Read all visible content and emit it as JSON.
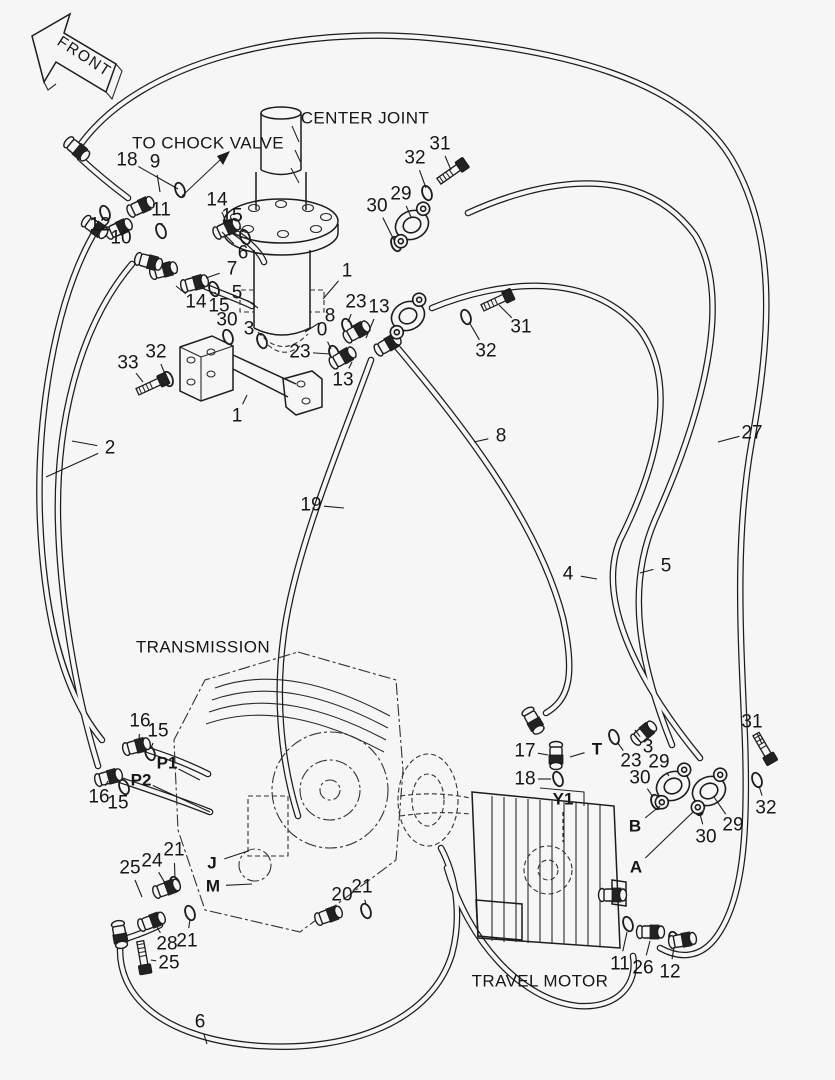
{
  "page": {
    "background": "#f6f6f6",
    "line_color": "#1c1c1c",
    "width": 835,
    "height": 1080
  },
  "front_arrow": {
    "label": "FRONT"
  },
  "labels": [
    {
      "id": "front",
      "text": "FRONT",
      "x": 84,
      "y": 57,
      "size": 15.5,
      "rot": 33,
      "spacing": 1.5
    },
    {
      "id": "to-chock-valve",
      "text": "TO CHOCK VALVE",
      "x": 208,
      "y": 143,
      "size": 17
    },
    {
      "id": "center-joint",
      "text": "CENTER JOINT",
      "x": 365,
      "y": 118,
      "size": 17
    },
    {
      "id": "transmission",
      "text": "TRANSMISSION",
      "x": 203,
      "y": 647,
      "size": 17
    },
    {
      "id": "travel-motor",
      "text": "TRAVEL MOTOR",
      "x": 540,
      "y": 981,
      "size": 17
    }
  ],
  "callouts": [
    {
      "n": "18",
      "x": 127,
      "y": 160,
      "lx": 178,
      "ly": 189
    },
    {
      "n": "9",
      "x": 155,
      "y": 162,
      "lx": 160,
      "ly": 192
    },
    {
      "n": "11",
      "x": 161,
      "y": 210,
      "lx": 162,
      "ly": 226
    },
    {
      "n": "12",
      "x": 100,
      "y": 225,
      "lx": 105,
      "ly": 216
    },
    {
      "n": "10",
      "x": 121,
      "y": 238,
      "lx": 121,
      "ly": 231
    },
    {
      "n": "14",
      "x": 217,
      "y": 200,
      "lx": 226,
      "ly": 222
    },
    {
      "n": "15",
      "x": 232,
      "y": 216,
      "lx": 243,
      "ly": 232
    },
    {
      "n": "6",
      "x": 243,
      "y": 253,
      "lx": 222,
      "ly": 232
    },
    {
      "n": "7",
      "x": 232,
      "y": 269,
      "lx": 206,
      "ly": 278
    },
    {
      "n": "5",
      "x": 237,
      "y": 293,
      "lx": 258,
      "ly": 308
    },
    {
      "n": "14",
      "x": 196,
      "y": 302,
      "lx": 176,
      "ly": 286
    },
    {
      "n": "15",
      "x": 219,
      "y": 306,
      "lx": 215,
      "ly": 292
    },
    {
      "n": "30",
      "x": 227,
      "y": 320,
      "lx": 228,
      "ly": 333
    },
    {
      "n": "3",
      "x": 249,
      "y": 329,
      "lx": 259,
      "ly": 338
    },
    {
      "n": "1",
      "x": 347,
      "y": 271,
      "lx": 323,
      "ly": 299
    },
    {
      "n": "8",
      "x": 330,
      "y": 316,
      "lx": 305,
      "ly": 332
    },
    {
      "n": "23",
      "x": 356,
      "y": 302,
      "lx": 348,
      "ly": 322
    },
    {
      "n": "13",
      "x": 379,
      "y": 307,
      "lx": 366,
      "ly": 338
    },
    {
      "n": "0",
      "x": 322,
      "y": 330,
      "lx": 331,
      "ly": 349
    },
    {
      "n": "23",
      "x": 300,
      "y": 352,
      "lx": 330,
      "ly": 354
    },
    {
      "n": "13",
      "x": 343,
      "y": 380,
      "lx": 352,
      "ly": 362
    },
    {
      "n": "33",
      "x": 128,
      "y": 363,
      "lx": 143,
      "ly": 382
    },
    {
      "n": "32",
      "x": 156,
      "y": 352,
      "lx": 165,
      "ly": 374
    },
    {
      "n": "1",
      "x": 237,
      "y": 416,
      "lx": 247,
      "ly": 395
    },
    {
      "n": "30",
      "x": 377,
      "y": 206,
      "lx": 394,
      "ly": 240
    },
    {
      "n": "29",
      "x": 401,
      "y": 194,
      "lx": 411,
      "ly": 217
    },
    {
      "n": "32",
      "x": 415,
      "y": 158,
      "lx": 426,
      "ly": 188
    },
    {
      "n": "31",
      "x": 440,
      "y": 144,
      "lx": 451,
      "ly": 170
    },
    {
      "n": "31",
      "x": 521,
      "y": 327,
      "lx": 499,
      "ly": 305
    },
    {
      "n": "32",
      "x": 486,
      "y": 351,
      "lx": 469,
      "ly": 322
    },
    {
      "n": "2",
      "x": 110,
      "y": 448,
      "lx": 72,
      "ly": 441,
      "lx2": 46,
      "ly2": 477
    },
    {
      "n": "8",
      "x": 501,
      "y": 436,
      "lx": 474,
      "ly": 442
    },
    {
      "n": "19",
      "x": 311,
      "y": 505,
      "lx": 344,
      "ly": 508
    },
    {
      "n": "27",
      "x": 752,
      "y": 433,
      "lx": 718,
      "ly": 442
    },
    {
      "n": "4",
      "x": 568,
      "y": 574,
      "lx": 597,
      "ly": 579
    },
    {
      "n": "5",
      "x": 666,
      "y": 566,
      "lx": 640,
      "ly": 573
    },
    {
      "n": "16",
      "x": 140,
      "y": 721,
      "lx": 139,
      "ly": 741
    },
    {
      "n": "15",
      "x": 158,
      "y": 731,
      "lx": 151,
      "ly": 748
    },
    {
      "n": "P1",
      "x": 167,
      "y": 763,
      "b": true,
      "lx": 200,
      "ly": 780
    },
    {
      "n": "P2",
      "x": 141,
      "y": 780,
      "b": true,
      "lx": 210,
      "ly": 812
    },
    {
      "n": "16",
      "x": 99,
      "y": 797,
      "lx": 108,
      "ly": 781
    },
    {
      "n": "15",
      "x": 118,
      "y": 803,
      "lx": 122,
      "ly": 790
    },
    {
      "n": "25",
      "x": 130,
      "y": 868,
      "lx": 142,
      "ly": 897
    },
    {
      "n": "24",
      "x": 152,
      "y": 861,
      "lx": 165,
      "ly": 883
    },
    {
      "n": "21",
      "x": 174,
      "y": 850,
      "lx": 175,
      "ly": 878
    },
    {
      "n": "J",
      "x": 212,
      "y": 863,
      "b": true,
      "lx": 248,
      "ly": 851
    },
    {
      "n": "M",
      "x": 213,
      "y": 886,
      "b": true,
      "lx": 252,
      "ly": 884
    },
    {
      "n": "28",
      "x": 167,
      "y": 944,
      "lx": 157,
      "ly": 927
    },
    {
      "n": "21",
      "x": 187,
      "y": 941,
      "lx": 190,
      "ly": 919
    },
    {
      "n": "25",
      "x": 169,
      "y": 963,
      "lx": 151,
      "ly": 960
    },
    {
      "n": "20",
      "x": 342,
      "y": 895,
      "lx": 333,
      "ly": 911
    },
    {
      "n": "21",
      "x": 362,
      "y": 887,
      "lx": 366,
      "ly": 905
    },
    {
      "n": "17",
      "x": 525,
      "y": 751,
      "lx": 548,
      "ly": 755
    },
    {
      "n": "18",
      "x": 525,
      "y": 779,
      "lx": 551,
      "ly": 779
    },
    {
      "n": "Y1",
      "x": 563,
      "y": 799,
      "b": true,
      "lx": 563,
      "ly": 842,
      "dash": true
    },
    {
      "n": "T",
      "x": 597,
      "y": 749,
      "b": true,
      "lx": 570,
      "ly": 757
    },
    {
      "n": "23",
      "x": 631,
      "y": 761,
      "lx": 617,
      "ly": 742
    },
    {
      "n": "3",
      "x": 648,
      "y": 747,
      "lx": 635,
      "ly": 730
    },
    {
      "n": "29",
      "x": 659,
      "y": 762,
      "lx": 669,
      "ly": 776
    },
    {
      "n": "30",
      "x": 640,
      "y": 778,
      "lx": 653,
      "ly": 797
    },
    {
      "n": "B",
      "x": 635,
      "y": 826,
      "b": true,
      "lx": 660,
      "ly": 806
    },
    {
      "n": "A",
      "x": 636,
      "y": 867,
      "b": true,
      "lx": 693,
      "ly": 812
    },
    {
      "n": "30",
      "x": 706,
      "y": 837,
      "lx": 700,
      "ly": 814
    },
    {
      "n": "29",
      "x": 733,
      "y": 825,
      "lx": 714,
      "ly": 797
    },
    {
      "n": "31",
      "x": 752,
      "y": 722,
      "lx": 762,
      "ly": 744
    },
    {
      "n": "32",
      "x": 766,
      "y": 808,
      "lx": 759,
      "ly": 786
    },
    {
      "n": "11",
      "x": 620,
      "y": 964,
      "lx": 627,
      "ly": 932
    },
    {
      "n": "26",
      "x": 643,
      "y": 968,
      "lx": 650,
      "ly": 941
    },
    {
      "n": "12",
      "x": 670,
      "y": 972,
      "lx": 674,
      "ly": 947
    },
    {
      "n": "6",
      "x": 200,
      "y": 1022,
      "lx": 207,
      "ly": 1044
    }
  ],
  "symbols": {
    "orings": [
      [
        105,
        213
      ],
      [
        180,
        190
      ],
      [
        161,
        231
      ],
      [
        245,
        237
      ],
      [
        214,
        289
      ],
      [
        228,
        337
      ],
      [
        262,
        341
      ],
      [
        347,
        326
      ],
      [
        334,
        353
      ],
      [
        396,
        244
      ],
      [
        168,
        379
      ],
      [
        427,
        193
      ],
      [
        466,
        317
      ],
      [
        150,
        753
      ],
      [
        124,
        787
      ],
      [
        175,
        884
      ],
      [
        190,
        913
      ],
      [
        366,
        911
      ],
      [
        558,
        779
      ],
      [
        614,
        737
      ],
      [
        656,
        802
      ],
      [
        698,
        808
      ],
      [
        757,
        780
      ],
      [
        628,
        924
      ],
      [
        674,
        939
      ]
    ],
    "fittings": [
      [
        142,
        206,
        -25
      ],
      [
        120,
        228,
        -25
      ],
      [
        228,
        228,
        -25
      ],
      [
        165,
        270,
        -15
      ],
      [
        196,
        283,
        -15
      ],
      [
        358,
        331,
        -30
      ],
      [
        344,
        357,
        -30
      ],
      [
        389,
        344,
        -30
      ],
      [
        138,
        746,
        -15
      ],
      [
        110,
        777,
        -15
      ],
      [
        168,
        888,
        -20
      ],
      [
        153,
        921,
        -20
      ],
      [
        556,
        757,
        90
      ],
      [
        645,
        732,
        -40
      ],
      [
        652,
        932,
        0
      ],
      [
        614,
        895,
        0
      ],
      [
        78,
        150,
        40
      ],
      [
        150,
        262,
        15
      ],
      [
        120,
        936,
        80
      ],
      [
        534,
        722,
        60
      ],
      [
        684,
        940,
        -10
      ],
      [
        330,
        915,
        -20
      ],
      [
        96,
        228,
        35
      ]
    ],
    "bolts": [
      [
        152,
        385,
        -25
      ],
      [
        452,
        172,
        -35
      ],
      [
        497,
        301,
        -25
      ],
      [
        764,
        748,
        60
      ],
      [
        143,
        957,
        80
      ]
    ],
    "flanges": [
      [
        412,
        225,
        -25
      ],
      [
        408,
        316,
        -25
      ],
      [
        673,
        786,
        -25
      ],
      [
        709,
        791,
        -25
      ]
    ]
  }
}
